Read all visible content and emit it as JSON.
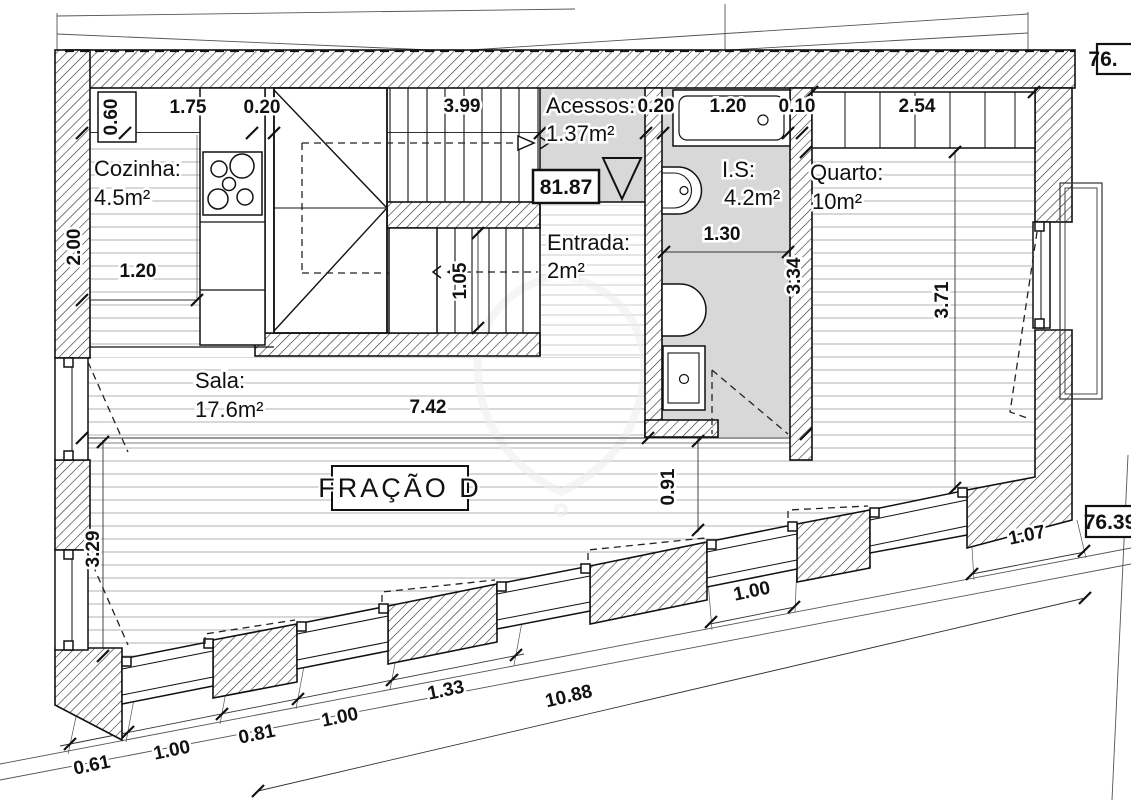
{
  "title": "FRAÇÃO D",
  "colors": {
    "line": "#111111",
    "wet_area_fill": "#d8d8d8",
    "floor_line": "#a8a8a8",
    "entry_floor_line": "#c6c6c6",
    "site_line": "#555555"
  },
  "rooms": {
    "cozinha": {
      "name": "Cozinha:",
      "area": "4.5m²"
    },
    "sala": {
      "name": "Sala:",
      "area": "17.6m²"
    },
    "entrada": {
      "name": "Entrada:",
      "area": "2m²"
    },
    "acessos": {
      "name": "Acessos:",
      "area": "1.37m²"
    },
    "is": {
      "name": "I.S:",
      "area": "4.2m²"
    },
    "quarto": {
      "name": "Quarto:",
      "area": "10m²"
    }
  },
  "levels": {
    "landing": "81.87",
    "site_upper": "76.",
    "site_lower": "76.39"
  },
  "dims": {
    "top_060": "0.60",
    "top_175": "1.75",
    "top_020a": "0.20",
    "top_399": "3.99",
    "top_020b": "0.20",
    "top_120": "1.20",
    "top_010": "0.10",
    "top_254": "2.54",
    "left_200": "2.00",
    "kitchen_120": "1.20",
    "stair_105": "1.05",
    "bath_130": "1.30",
    "sala_742": "7.42",
    "sala_329": "3.29",
    "mid_091": "0.91",
    "right_334": "3.34",
    "right_371": "3.71",
    "bot_061": "0.61",
    "bot_100a": "1.00",
    "bot_081": "0.81",
    "bot_100b": "1.00",
    "bot_133": "1.33",
    "bot_1088": "10.88",
    "bot_100c": "1.00",
    "bot_107": "1.07"
  }
}
